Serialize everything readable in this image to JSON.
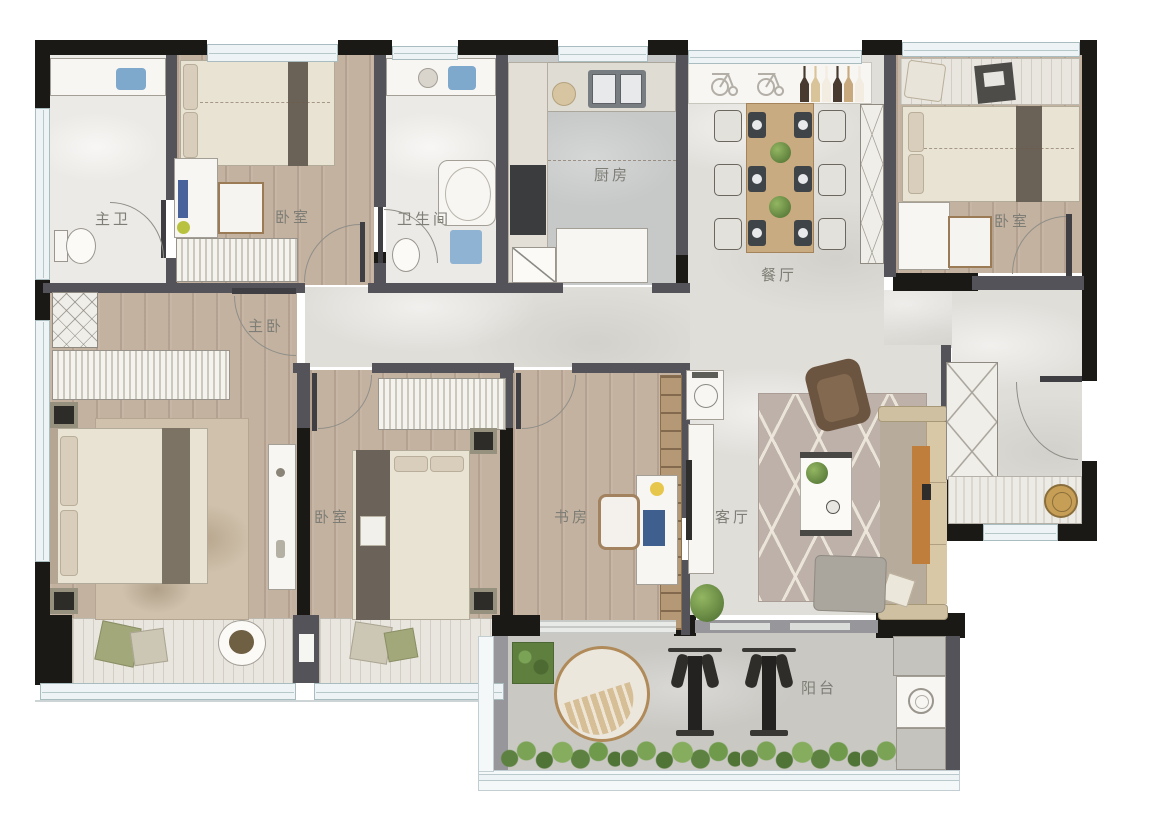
{
  "plan": {
    "type": "apartment-floor-plan",
    "rooms": [
      {
        "id": "master-bath",
        "label": "主卫"
      },
      {
        "id": "bedroom-top-left",
        "label": "卧室"
      },
      {
        "id": "bathroom",
        "label": "卫生间"
      },
      {
        "id": "kitchen",
        "label": "厨房"
      },
      {
        "id": "dining-room",
        "label": "餐厅"
      },
      {
        "id": "bedroom-top-right",
        "label": "卧室"
      },
      {
        "id": "master-bedroom",
        "label": "主卧"
      },
      {
        "id": "bedroom-middle",
        "label": "卧室"
      },
      {
        "id": "study",
        "label": "书房"
      },
      {
        "id": "living-room",
        "label": "客厅"
      },
      {
        "id": "balcony",
        "label": "阳台"
      }
    ],
    "colors": {
      "exterior_wall": "#1a1916",
      "partition_wall": "#54535a",
      "wood_floor": "#c4b2a1",
      "marble_floor": "#e0ded9",
      "bath_floor": "#eceae6",
      "kitchen_floor": "#c7c9c8",
      "balcony_floor": "#c9c8c3",
      "window": "#eef4f5",
      "greenery": "#6f9a4c",
      "sofa_beige": "#cbbb9e",
      "accent_orange": "#c07e3d",
      "label_text": "#7e7e76"
    }
  }
}
